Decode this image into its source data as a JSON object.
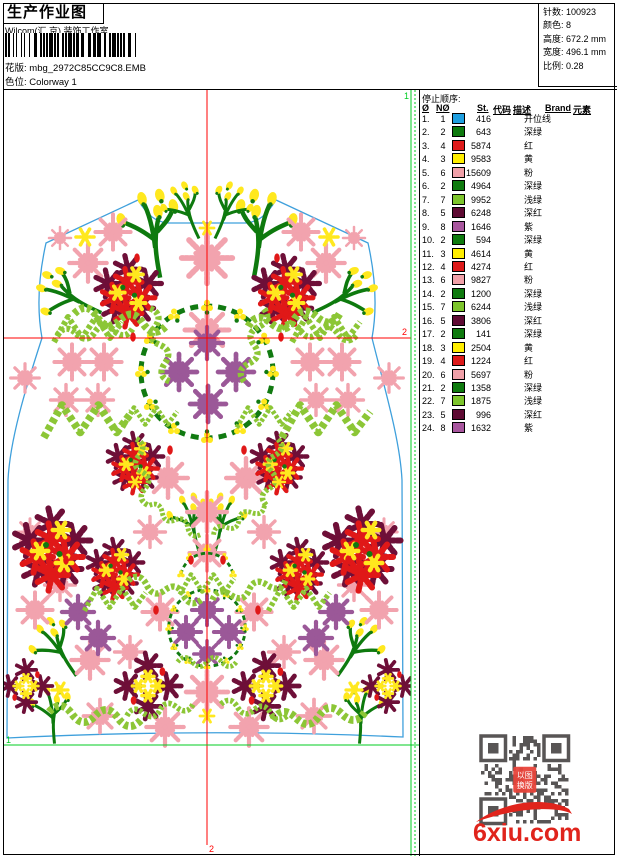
{
  "page": {
    "title": "生产作业图",
    "company": "Wilcom(汇 京) 装饰工作室",
    "pattern_label": "花版:",
    "pattern_value": "mbg_2972C85CC9C8.EMB",
    "colorway_label": "色位:",
    "colorway_value": "Colorway 1"
  },
  "info": {
    "stitches_label": "针数:",
    "stitches": "100923",
    "colors_label": "颜色:",
    "colors": "8",
    "height_label": "高度:",
    "height": "672.2 mm",
    "width_label": "宽度:",
    "width": "496.1 mm",
    "scale_label": "比例:",
    "scale": "0.28"
  },
  "table": {
    "section_title": "停止顺序:",
    "headers": {
      "stop": "Ø",
      "needle": "NØ",
      "st": "St.",
      "code": "代码",
      "desc": "描述",
      "brand": "Brand",
      "element": "元素"
    },
    "rows": [
      {
        "n": "1.",
        "needle": "1",
        "color": "#1F9FE0",
        "st": "416",
        "desc": "开位线"
      },
      {
        "n": "2.",
        "needle": "2",
        "color": "#0E7A0E",
        "st": "643",
        "desc": "深绿"
      },
      {
        "n": "3.",
        "needle": "4",
        "color": "#DD1A1A",
        "st": "5874",
        "desc": "红"
      },
      {
        "n": "4.",
        "needle": "3",
        "color": "#FFEE00",
        "st": "9583",
        "desc": "黄"
      },
      {
        "n": "5.",
        "needle": "6",
        "color": "#F0A0A8",
        "st": "15609",
        "desc": "粉"
      },
      {
        "n": "6.",
        "needle": "2",
        "color": "#0E7A0E",
        "st": "4964",
        "desc": "深绿"
      },
      {
        "n": "7.",
        "needle": "7",
        "color": "#7DC52C",
        "st": "9952",
        "desc": "浅绿"
      },
      {
        "n": "8.",
        "needle": "5",
        "color": "#5E0A33",
        "st": "6248",
        "desc": "深红"
      },
      {
        "n": "9.",
        "needle": "8",
        "color": "#A8569E",
        "st": "1646",
        "desc": "紫"
      },
      {
        "n": "10.",
        "needle": "2",
        "color": "#0E7A0E",
        "st": "594",
        "desc": "深绿"
      },
      {
        "n": "11.",
        "needle": "3",
        "color": "#FFEE00",
        "st": "4614",
        "desc": "黄"
      },
      {
        "n": "12.",
        "needle": "4",
        "color": "#DD1A1A",
        "st": "4274",
        "desc": "红"
      },
      {
        "n": "13.",
        "needle": "6",
        "color": "#F0A0A8",
        "st": "9827",
        "desc": "粉"
      },
      {
        "n": "14.",
        "needle": "2",
        "color": "#0E7A0E",
        "st": "1200",
        "desc": "深绿"
      },
      {
        "n": "15.",
        "needle": "7",
        "color": "#7DC52C",
        "st": "6244",
        "desc": "浅绿"
      },
      {
        "n": "16.",
        "needle": "5",
        "color": "#5E0A33",
        "st": "3806",
        "desc": "深红"
      },
      {
        "n": "17.",
        "needle": "2",
        "color": "#0E7A0E",
        "st": "141",
        "desc": "深绿"
      },
      {
        "n": "18.",
        "needle": "3",
        "color": "#FFEE00",
        "st": "2504",
        "desc": "黄"
      },
      {
        "n": "19.",
        "needle": "4",
        "color": "#DD1A1A",
        "st": "1224",
        "desc": "红"
      },
      {
        "n": "20.",
        "needle": "6",
        "color": "#F0A0A8",
        "st": "5697",
        "desc": "粉"
      },
      {
        "n": "21.",
        "needle": "2",
        "color": "#0E7A0E",
        "st": "1358",
        "desc": "深绿"
      },
      {
        "n": "22.",
        "needle": "7",
        "color": "#7DC52C",
        "st": "1875",
        "desc": "浅绿"
      },
      {
        "n": "23.",
        "needle": "5",
        "color": "#5E0A33",
        "st": "996",
        "desc": "深红"
      },
      {
        "n": "24.",
        "needle": "8",
        "color": "#A8569E",
        "st": "1632",
        "desc": "紫"
      }
    ]
  },
  "design": {
    "marker1_label": "1",
    "marker2_label": "2",
    "colors": {
      "pink": "#F2A3AE",
      "purple": "#9B5898",
      "red": "#E01818",
      "maroon": "#6E0F38",
      "yellow": "#FFE81E",
      "lightgreen": "#8CC636",
      "darkgreen": "#117A11",
      "stem": "#0E7A0E",
      "vest": "#3FA0DC",
      "guide_red": "#FF0000",
      "guide_green": "#00CC22"
    },
    "vest_path": "M 42,338 C 36,305 40,270 46,243 L 138,200 C 148,216 156,222 168,223 L 246,223 C 258,222 266,216 276,200 L 368,243 C 374,270 378,305 372,338 C 385,390 400,440 402,480 L 403,737 Q 207,728 7,738 L 8,480 C 10,440 25,390 42,338 Z",
    "motifs": [
      {
        "t": "sprig",
        "x": 150,
        "y": 240,
        "s": 1.5,
        "r": -15
      },
      {
        "t": "sprig",
        "x": 264,
        "y": 240,
        "s": 1.5,
        "r": 15,
        "f": 1
      },
      {
        "t": "sprig",
        "x": 186,
        "y": 216,
        "s": 1.0,
        "r": -30
      },
      {
        "t": "sprig",
        "x": 228,
        "y": 216,
        "s": 1.0,
        "r": 30,
        "f": 1
      },
      {
        "t": "sprig",
        "x": 72,
        "y": 302,
        "s": 1.2,
        "r": -70
      },
      {
        "t": "sprig",
        "x": 342,
        "y": 302,
        "s": 1.2,
        "r": 70,
        "f": 1
      },
      {
        "t": "sprig",
        "x": 190,
        "y": 527,
        "s": 1.0,
        "r": -20
      },
      {
        "t": "sprig",
        "x": 224,
        "y": 527,
        "s": 1.0,
        "r": 20,
        "f": 1
      },
      {
        "t": "sprig",
        "x": 58,
        "y": 654,
        "s": 1.1,
        "r": -40
      },
      {
        "t": "sprig",
        "x": 356,
        "y": 654,
        "s": 1.1,
        "r": 40,
        "f": 1
      },
      {
        "t": "sprig",
        "x": 50,
        "y": 718,
        "s": 1.0,
        "r": -10
      },
      {
        "t": "sprig",
        "x": 364,
        "y": 718,
        "s": 1.0,
        "r": 10,
        "f": 1
      },
      {
        "t": "pink",
        "x": 113,
        "y": 232,
        "s": 0.8
      },
      {
        "t": "pink",
        "x": 301,
        "y": 232,
        "s": 0.8
      },
      {
        "t": "pink",
        "x": 88,
        "y": 263,
        "s": 0.85
      },
      {
        "t": "pink",
        "x": 326,
        "y": 263,
        "s": 0.85
      },
      {
        "t": "pink",
        "x": 60,
        "y": 238,
        "s": 0.5
      },
      {
        "t": "pink",
        "x": 354,
        "y": 238,
        "s": 0.5
      },
      {
        "t": "pink",
        "x": 207,
        "y": 258,
        "s": 1.15
      },
      {
        "t": "pink",
        "x": 207,
        "y": 330,
        "s": 1.0
      },
      {
        "t": "pink",
        "x": 25,
        "y": 378,
        "s": 0.65
      },
      {
        "t": "pink",
        "x": 389,
        "y": 378,
        "s": 0.65
      },
      {
        "t": "pink",
        "x": 72,
        "y": 362,
        "s": 0.8
      },
      {
        "t": "pink",
        "x": 104,
        "y": 362,
        "s": 0.8
      },
      {
        "t": "pink",
        "x": 310,
        "y": 362,
        "s": 0.8
      },
      {
        "t": "pink",
        "x": 342,
        "y": 362,
        "s": 0.8
      },
      {
        "t": "pink",
        "x": 66,
        "y": 400,
        "s": 0.7
      },
      {
        "t": "pink",
        "x": 98,
        "y": 400,
        "s": 0.7
      },
      {
        "t": "pink",
        "x": 316,
        "y": 400,
        "s": 0.7
      },
      {
        "t": "pink",
        "x": 348,
        "y": 400,
        "s": 0.7
      },
      {
        "t": "pink",
        "x": 168,
        "y": 478,
        "s": 0.9
      },
      {
        "t": "pink",
        "x": 246,
        "y": 478,
        "s": 0.9
      },
      {
        "t": "pink",
        "x": 207,
        "y": 512,
        "s": 0.9
      },
      {
        "t": "pink",
        "x": 150,
        "y": 532,
        "s": 0.7
      },
      {
        "t": "pink",
        "x": 264,
        "y": 532,
        "s": 0.7
      },
      {
        "t": "pink",
        "x": 207,
        "y": 553,
        "s": 0.8
      },
      {
        "t": "pink",
        "x": 30,
        "y": 532,
        "s": 0.6
      },
      {
        "t": "pink",
        "x": 384,
        "y": 532,
        "s": 0.6
      },
      {
        "t": "pink",
        "x": 35,
        "y": 610,
        "s": 0.8
      },
      {
        "t": "pink",
        "x": 160,
        "y": 612,
        "s": 0.8
      },
      {
        "t": "pink",
        "x": 254,
        "y": 612,
        "s": 0.8
      },
      {
        "t": "pink",
        "x": 379,
        "y": 610,
        "s": 0.8
      },
      {
        "t": "pink",
        "x": 60,
        "y": 585,
        "s": 0.7
      },
      {
        "t": "pink",
        "x": 354,
        "y": 585,
        "s": 0.7
      },
      {
        "t": "pink",
        "x": 90,
        "y": 660,
        "s": 0.85
      },
      {
        "t": "pink",
        "x": 324,
        "y": 660,
        "s": 0.85
      },
      {
        "t": "pink",
        "x": 130,
        "y": 652,
        "s": 0.7
      },
      {
        "t": "pink",
        "x": 284,
        "y": 652,
        "s": 0.7
      },
      {
        "t": "pink",
        "x": 207,
        "y": 692,
        "s": 0.95
      },
      {
        "t": "pink",
        "x": 100,
        "y": 716,
        "s": 0.75
      },
      {
        "t": "pink",
        "x": 314,
        "y": 716,
        "s": 0.75
      },
      {
        "t": "pink",
        "x": 165,
        "y": 727,
        "s": 0.85
      },
      {
        "t": "pink",
        "x": 249,
        "y": 727,
        "s": 0.85
      },
      {
        "t": "purple",
        "x": 207,
        "y": 343,
        "s": 0.85
      },
      {
        "t": "purple",
        "x": 179,
        "y": 372,
        "s": 0.95
      },
      {
        "t": "purple",
        "x": 236,
        "y": 372,
        "s": 0.95
      },
      {
        "t": "purple",
        "x": 208,
        "y": 404,
        "s": 0.95
      },
      {
        "t": "purple",
        "x": 207,
        "y": 610,
        "s": 0.8
      },
      {
        "t": "purple",
        "x": 186,
        "y": 632,
        "s": 0.8
      },
      {
        "t": "purple",
        "x": 229,
        "y": 632,
        "s": 0.8
      },
      {
        "t": "purple",
        "x": 207,
        "y": 654,
        "s": 0.7
      },
      {
        "t": "purple",
        "x": 78,
        "y": 612,
        "s": 0.85
      },
      {
        "t": "purple",
        "x": 98,
        "y": 638,
        "s": 0.85
      },
      {
        "t": "purple",
        "x": 336,
        "y": 612,
        "s": 0.85
      },
      {
        "t": "purple",
        "x": 316,
        "y": 638,
        "s": 0.85
      },
      {
        "t": "red",
        "x": 128,
        "y": 290,
        "s": 1.3
      },
      {
        "t": "red",
        "x": 286,
        "y": 290,
        "s": 1.3
      },
      {
        "t": "red",
        "x": 135,
        "y": 462,
        "s": 1.1
      },
      {
        "t": "red",
        "x": 279,
        "y": 462,
        "s": 1.1
      },
      {
        "t": "red",
        "x": 52,
        "y": 548,
        "s": 1.5
      },
      {
        "t": "red",
        "x": 362,
        "y": 548,
        "s": 1.5
      },
      {
        "t": "red",
        "x": 115,
        "y": 568,
        "s": 1.1
      },
      {
        "t": "red",
        "x": 299,
        "y": 568,
        "s": 1.1
      },
      {
        "t": "maroonx",
        "x": 148,
        "y": 686,
        "s": 1.2
      },
      {
        "t": "maroonx",
        "x": 266,
        "y": 686,
        "s": 1.2
      },
      {
        "t": "maroonx",
        "x": 26,
        "y": 686,
        "s": 0.95
      },
      {
        "t": "maroonx",
        "x": 388,
        "y": 686,
        "s": 0.95
      },
      {
        "t": "wreath",
        "x": 207,
        "y": 372,
        "s": 1.0
      },
      {
        "t": "wreath",
        "x": 207,
        "y": 628,
        "s": 0.58
      },
      {
        "t": "arc",
        "x": 207,
        "y": 568,
        "s": 0.62
      },
      {
        "t": "garland",
        "x": 120,
        "y": 320,
        "s": 1.1,
        "r": 8
      },
      {
        "t": "garland",
        "x": 294,
        "y": 320,
        "s": 1.1,
        "r": -8
      },
      {
        "t": "garland",
        "x": 160,
        "y": 345,
        "s": 0.9,
        "r": 75
      },
      {
        "t": "garland",
        "x": 254,
        "y": 345,
        "s": 0.9,
        "r": -75
      },
      {
        "t": "garland",
        "x": 95,
        "y": 332,
        "s": 0.9,
        "r": -5
      },
      {
        "t": "garland",
        "x": 319,
        "y": 332,
        "s": 0.9,
        "r": 5
      },
      {
        "t": "garland",
        "x": 142,
        "y": 472,
        "s": 0.8,
        "r": 80
      },
      {
        "t": "garland",
        "x": 272,
        "y": 472,
        "s": 0.8,
        "r": -80
      },
      {
        "t": "garland",
        "x": 175,
        "y": 520,
        "s": 0.7,
        "r": 30
      },
      {
        "t": "garland",
        "x": 239,
        "y": 520,
        "s": 0.7,
        "r": -30
      },
      {
        "t": "garland",
        "x": 165,
        "y": 590,
        "s": 0.9,
        "r": 15
      },
      {
        "t": "garland",
        "x": 249,
        "y": 590,
        "s": 0.9,
        "r": -15
      },
      {
        "t": "garland",
        "x": 207,
        "y": 662,
        "s": 0.7,
        "r": 0
      },
      {
        "t": "garland",
        "x": 95,
        "y": 716,
        "s": 1.1,
        "r": 5
      },
      {
        "t": "garland",
        "x": 319,
        "y": 716,
        "s": 1.1,
        "r": -5
      },
      {
        "t": "garland",
        "x": 160,
        "y": 710,
        "s": 0.8,
        "r": -10
      },
      {
        "t": "garland",
        "x": 254,
        "y": 710,
        "s": 0.8,
        "r": 10
      },
      {
        "t": "crown",
        "x": 88,
        "y": 330,
        "s": 1.0
      },
      {
        "t": "crown",
        "x": 326,
        "y": 330,
        "s": 1.0
      },
      {
        "t": "crown",
        "x": 88,
        "y": 422,
        "s": 1.3
      },
      {
        "t": "crown",
        "x": 326,
        "y": 422,
        "s": 1.3
      },
      {
        "t": "crown",
        "x": 150,
        "y": 418,
        "s": 0.8
      },
      {
        "t": "crown",
        "x": 264,
        "y": 418,
        "s": 0.8
      },
      {
        "t": "crown",
        "x": 115,
        "y": 600,
        "s": 0.9
      },
      {
        "t": "crown",
        "x": 299,
        "y": 600,
        "s": 0.9
      },
      {
        "t": "crown",
        "x": 207,
        "y": 585,
        "s": 0.8
      },
      {
        "t": "ystar",
        "x": 85,
        "y": 237,
        "s": 0.9
      },
      {
        "t": "ystar",
        "x": 329,
        "y": 237,
        "s": 0.9
      },
      {
        "t": "ystar",
        "x": 207,
        "y": 228,
        "s": 0.7
      },
      {
        "t": "ystar",
        "x": 60,
        "y": 690,
        "s": 0.8
      },
      {
        "t": "ystar",
        "x": 354,
        "y": 690,
        "s": 0.8
      },
      {
        "t": "ystar",
        "x": 135,
        "y": 482,
        "s": 0.6
      },
      {
        "t": "ystar",
        "x": 279,
        "y": 482,
        "s": 0.6
      },
      {
        "t": "ystar",
        "x": 207,
        "y": 716,
        "s": 0.7
      },
      {
        "t": "rdot",
        "x": 133,
        "y": 337
      },
      {
        "t": "rdot",
        "x": 281,
        "y": 337
      },
      {
        "t": "rdot",
        "x": 170,
        "y": 450
      },
      {
        "t": "rdot",
        "x": 244,
        "y": 450
      },
      {
        "t": "rdot",
        "x": 156,
        "y": 610
      },
      {
        "t": "rdot",
        "x": 258,
        "y": 610
      },
      {
        "t": "rdot",
        "x": 137,
        "y": 258
      },
      {
        "t": "rdot",
        "x": 277,
        "y": 258
      },
      {
        "t": "rdot",
        "x": 191,
        "y": 560
      },
      {
        "t": "rdot",
        "x": 223,
        "y": 560
      },
      {
        "t": "rdot",
        "x": 66,
        "y": 560
      },
      {
        "t": "rdot",
        "x": 348,
        "y": 560
      }
    ]
  },
  "watermark": {
    "site": "6xiu.com",
    "seal_line1": "以图",
    "seal_line2": "换版"
  }
}
